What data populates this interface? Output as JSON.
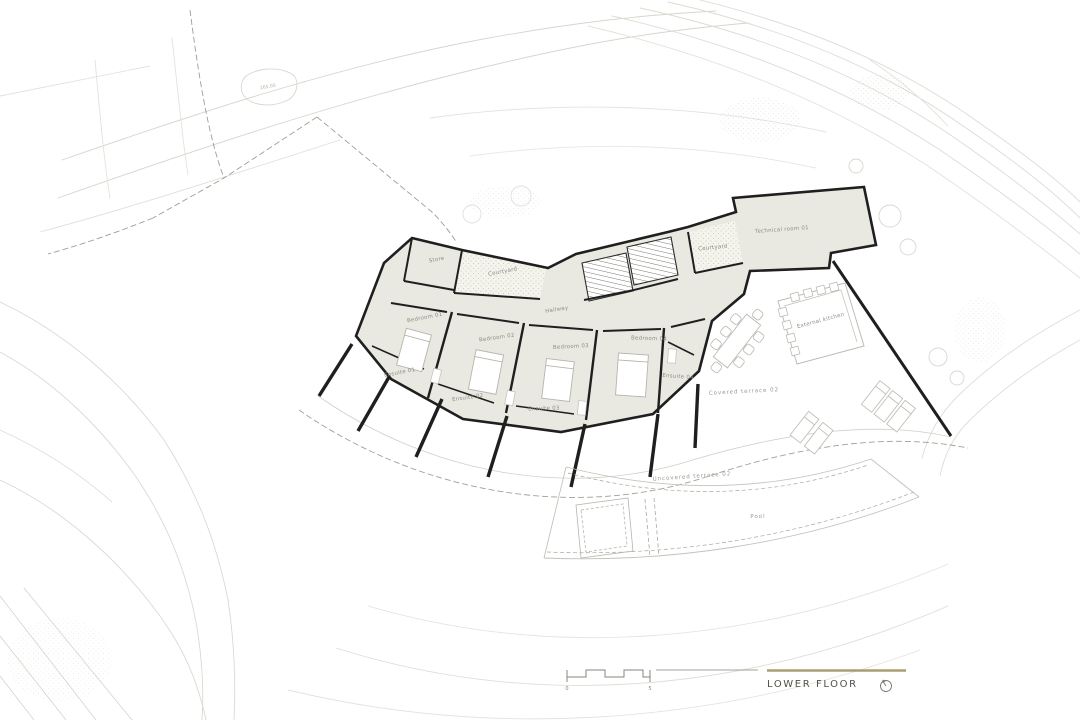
{
  "plan": {
    "title": "LOWER FLOOR",
    "rooms": {
      "store": "Store",
      "courtyard_left": "Courtyard",
      "hallway": "Hallway",
      "bedroom_01": "Bedroom 01",
      "bedroom_02": "Bedroom 02",
      "bedroom_03": "Bedroom 03",
      "bedroom_04": "Bedroom 04",
      "ensuite_01": "Ensuite 01",
      "ensuite_02": "Ensuite 02",
      "ensuite_03": "Ensuite 03",
      "ensuite_04": "Ensuite 04",
      "courtyard_right": "Courtyard",
      "technical_room": "Technical room 01",
      "external_kitchen": "External kitchen"
    },
    "outdoor": {
      "covered_terrace": "Covered terrace 02",
      "uncovered_terrace": "Uncovered terrace 02",
      "pool": "Pool"
    },
    "annotations": {
      "spot_elevation": "165.00",
      "scale_start": "0",
      "scale_end": "5"
    },
    "icons": {
      "compass": "north-indicator-circle",
      "scale_bar": "graphic-scale-bar",
      "stairs": "stair-flight-hatch",
      "dining_table": "dining-table-with-chairs",
      "loungers": "sun-loungers",
      "beds": "double-bed",
      "trees": "tree-canopy"
    },
    "colors": {
      "building_fill": "#eae9e1",
      "wall": "#1f1f1f",
      "furniture_line": "#bdbdb5",
      "contour_line": "#d9d9d1",
      "boundary_dash": "#9e9e96",
      "accent_gold": "#ab9d72",
      "room_label": "#8c8c84",
      "title_text": "#514f46"
    }
  }
}
